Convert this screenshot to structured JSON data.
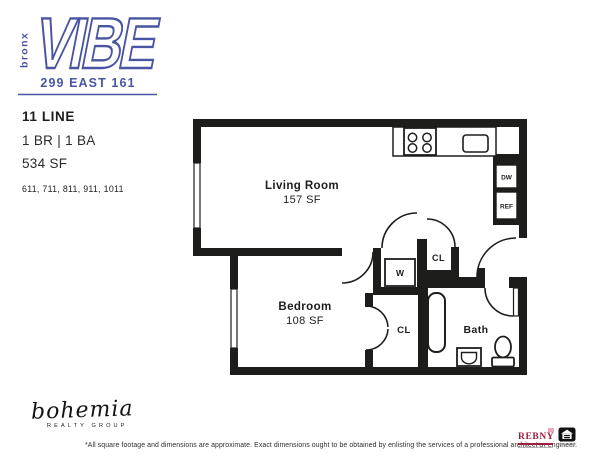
{
  "brand": {
    "name_vertical": "bronx",
    "name_main": "VIBE",
    "address": "299 EAST 161",
    "accent_color": "#4a55a2"
  },
  "unit": {
    "line_name": "11 LINE",
    "configuration": "1 BR | 1 BA",
    "square_feet": "534 SF",
    "unit_numbers": "611, 711, 811, 911, 1011"
  },
  "floorplan": {
    "living_room_label": "Living Room",
    "living_room_sf": "157 SF",
    "bedroom_label": "Bedroom",
    "bedroom_sf": "108 SF",
    "bath_label": "Bath",
    "hall_closet_label": "CL",
    "bedroom_closet_label": "CL",
    "washer_label": "W",
    "dishwasher_label": "DW",
    "refrigerator_label": "REF",
    "wall_color": "#1d1d1b"
  },
  "footer": {
    "realty_script": "bohemia",
    "realty_sub": "REALTY GROUP",
    "disclaimer": "*All square footage and dimensions are approximate. Exact dimensions ought to be obtained by enlisting the services of a professional architect or engineer.",
    "rebny_label": "REBNY",
    "eho_icon": "equal-housing-opportunity-icon"
  }
}
